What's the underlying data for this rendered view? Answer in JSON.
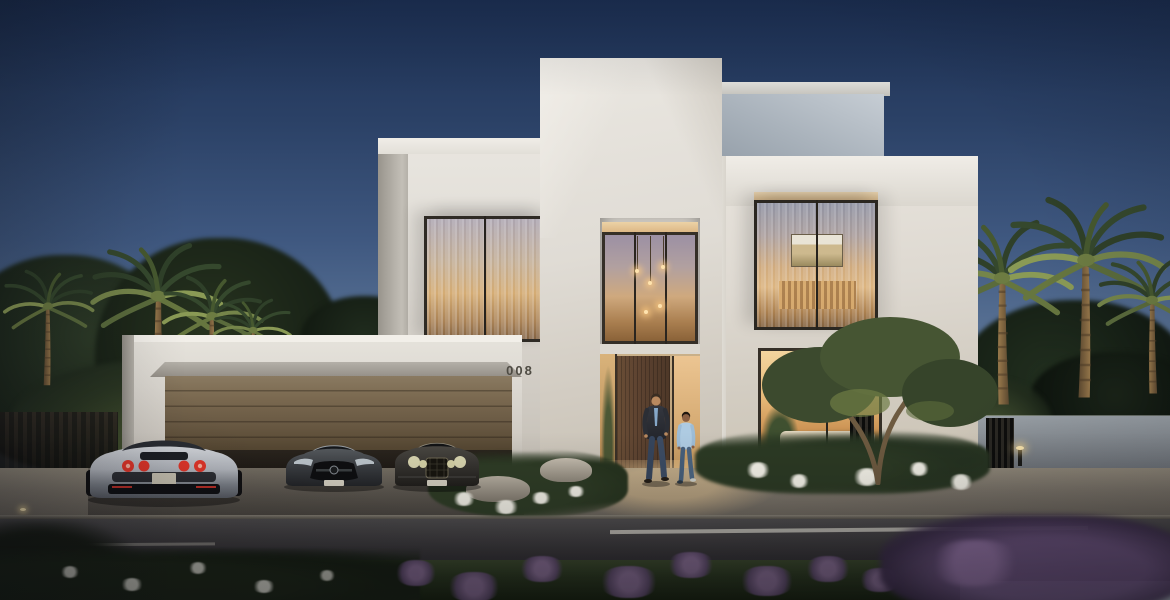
{
  "scene": {
    "description": "Modern luxury villa exterior at dusk with palm trees, three luxury cars and two people walking out",
    "house_number": "008"
  },
  "colors": {
    "sky_top": "#1c3054",
    "sky_horizon": "#aeb9c0",
    "villa_white": "#e9e6e0",
    "warm_window_glow": "#e9bd7c",
    "garage_door_bronze": "#75644d",
    "entry_door_wood": "#5c4230",
    "road_asphalt": "#333134",
    "foliage_dark": "#22301f",
    "taillight_red": "#e8372a",
    "flower_purple": "#7a5f86"
  }
}
